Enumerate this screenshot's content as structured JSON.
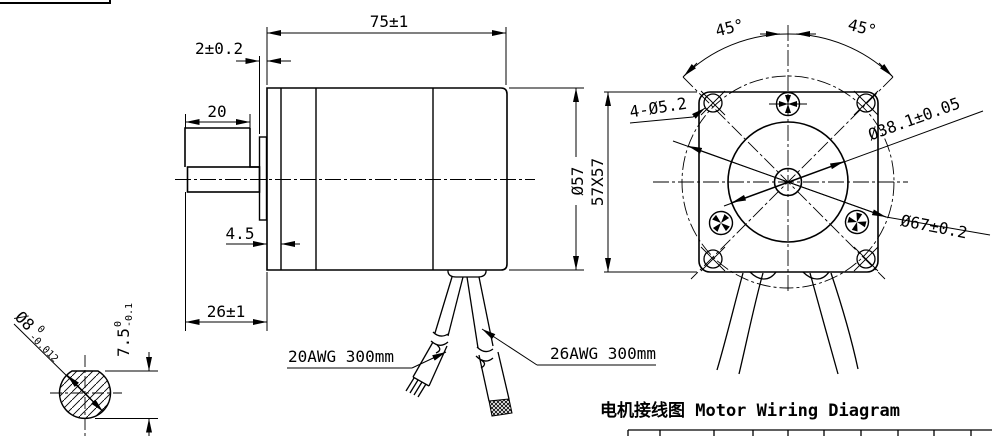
{
  "side_view": {
    "dim_length": "75±1",
    "dim_pilot_height": "2±0.2",
    "dim_shaft_length": "20",
    "dim_flange_thickness": "4.5",
    "dim_front_section": "26±1",
    "dim_body_diameter": "Ø57"
  },
  "shaft_detail": {
    "diameter": "Ø8",
    "diameter_tol_upper": "0",
    "diameter_tol_lower": "-0.012",
    "flat_height": "7.5",
    "flat_tol_upper": "0",
    "flat_tol_lower": "-0.1"
  },
  "front_view": {
    "angle_left": "45°",
    "angle_right": "45°",
    "mounting_holes": "4-Ø5.2",
    "pilot_diameter": "Ø38.1±0.05",
    "face_size": "57X57",
    "bolt_circle": "Ø67±0.2"
  },
  "wires": {
    "left_label": "20AWG 300mm",
    "right_label": "26AWG 300mm"
  },
  "wiring_title": "电机接线图 Motor Wiring Diagram",
  "colors": {
    "line": "#000000",
    "background": "#ffffff"
  }
}
